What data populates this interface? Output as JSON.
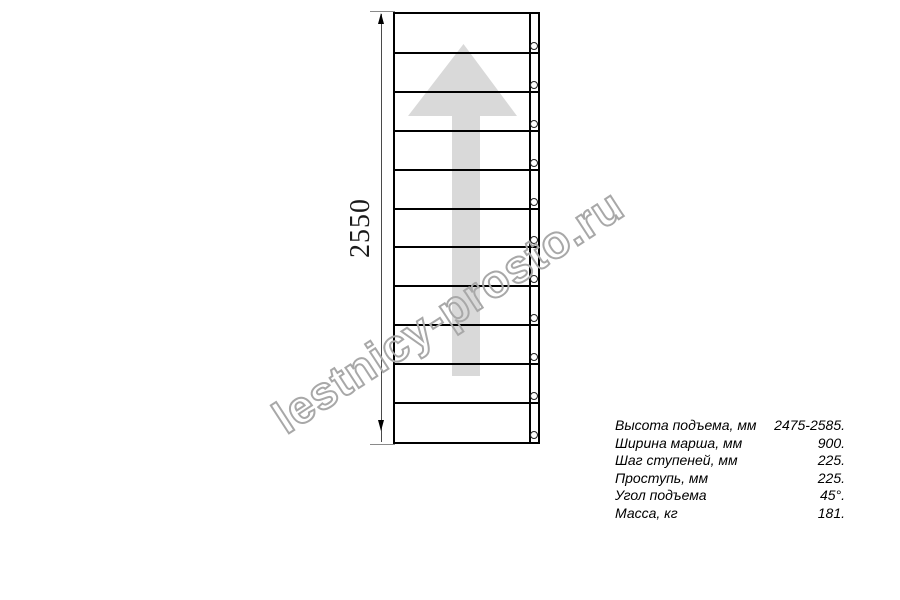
{
  "drawing": {
    "type": "staircase-plan-top-view",
    "dimension_label": "2550",
    "steps_count": 11,
    "line_color": "#000000",
    "arrow_color": "#d9d9d9"
  },
  "watermark": {
    "text": "lestnicy-prosto.ru",
    "outline_color": "#a8a8a8"
  },
  "specs": {
    "rows": [
      {
        "label": "Высота подъема, мм",
        "value": "2475-2585."
      },
      {
        "label": "Ширина марша, мм",
        "value": "900."
      },
      {
        "label": "Шаг ступеней, мм",
        "value": "225."
      },
      {
        "label": "Проступь, мм",
        "value": "225."
      },
      {
        "label": "Угол подъема",
        "value": "45°."
      },
      {
        "label": "Масса, кг",
        "value": "181."
      }
    ]
  }
}
